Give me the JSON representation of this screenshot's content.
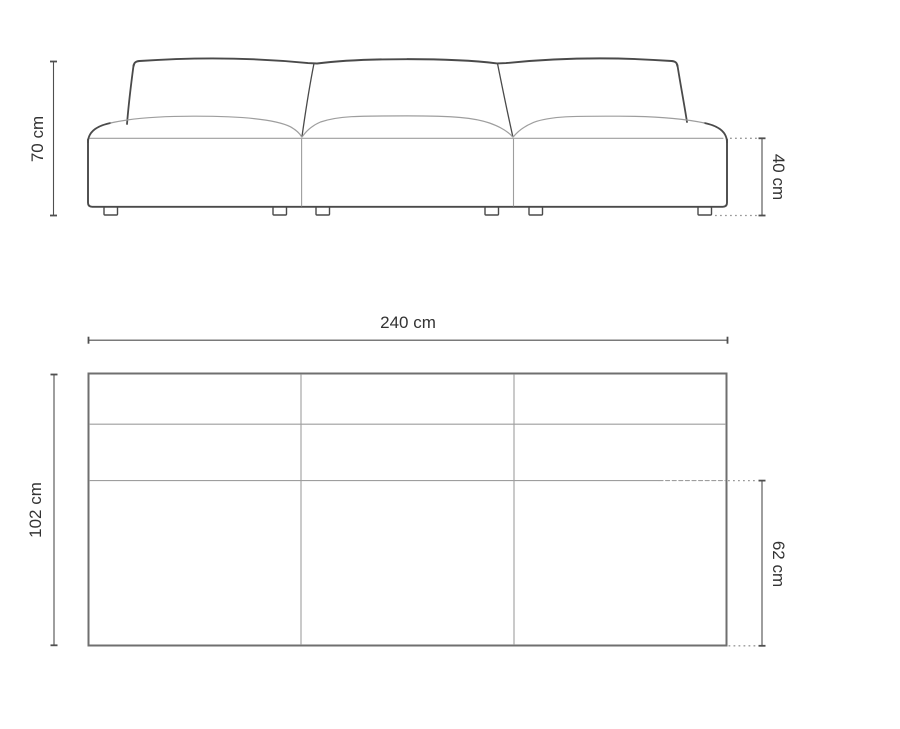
{
  "colors": {
    "outline": "#4a4a4a",
    "seam": "#9e9e9e",
    "plan_outline": "#6f6f6f",
    "dimension": "#4f4f4f",
    "dotted": "#9a9a9a",
    "text": "#333333",
    "background": "#ffffff"
  },
  "dimensions": {
    "front_total_height": "70 cm",
    "front_seat_height": "40 cm",
    "plan_total_width": "240 cm",
    "plan_total_depth": "102 cm",
    "plan_seat_depth": "62 cm"
  }
}
